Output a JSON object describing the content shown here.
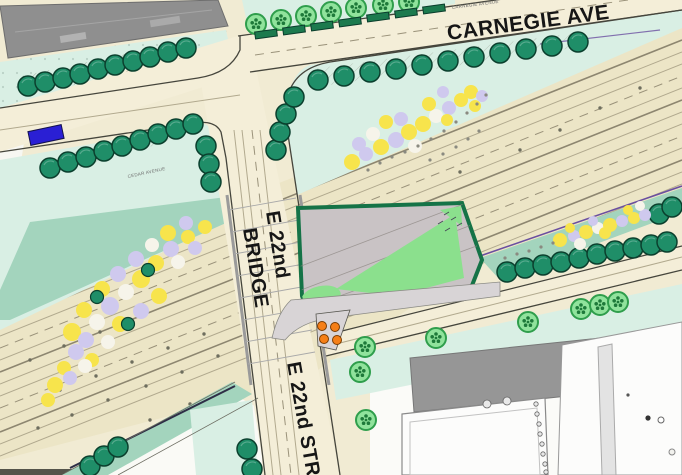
{
  "plan": {
    "labels": {
      "carnegie_ave": "CARNEGIE AVE",
      "carnegie_avenue_small": "CARNEGIE AVENUE",
      "cedar_avenue_small": "CEDAR AVENUE",
      "e22nd_line1": "E 22nd",
      "e22nd_line2": "BRIDGE",
      "e22nd_street": "E 22nd STR"
    },
    "features": {
      "street_tree": "existing street tree (dark teal circle with hatched shadow)",
      "ornamental_tree": "proposed ornamental tree (light green circle with blossom glyph)",
      "planter": "streetscape planter (dark green rectangle)",
      "flower_bed": "perennial planting bed (yellow / lavender cluster)",
      "site_parcel": "project parcel outlined in green with lawn panels",
      "orange_marker_count": 4,
      "blue_shelter_count": 1
    },
    "palette": {
      "road_beige": "#f1ebd3",
      "highway_beige": "#ece5c6",
      "lane_line": "#b1a98e",
      "planting_mint": "#d9efe4",
      "planting_teal": "#a3d4bd",
      "street_tree_green": "#1f8e68",
      "ornamental_tree_green": "#90e39c",
      "site_border_green": "#157347",
      "site_paving_gray": "#c9c3c5",
      "site_lawn_green": "#8be08d",
      "building_gray": "#8f8f8f",
      "building_white": "#fcfcfb",
      "flower_yellow": "#f7e44c",
      "flower_lavender": "#cfc9ee",
      "marker_orange": "#f57f17",
      "marker_blue": "#2a1fd4",
      "boundary_purple": "#6a4fa0"
    }
  }
}
